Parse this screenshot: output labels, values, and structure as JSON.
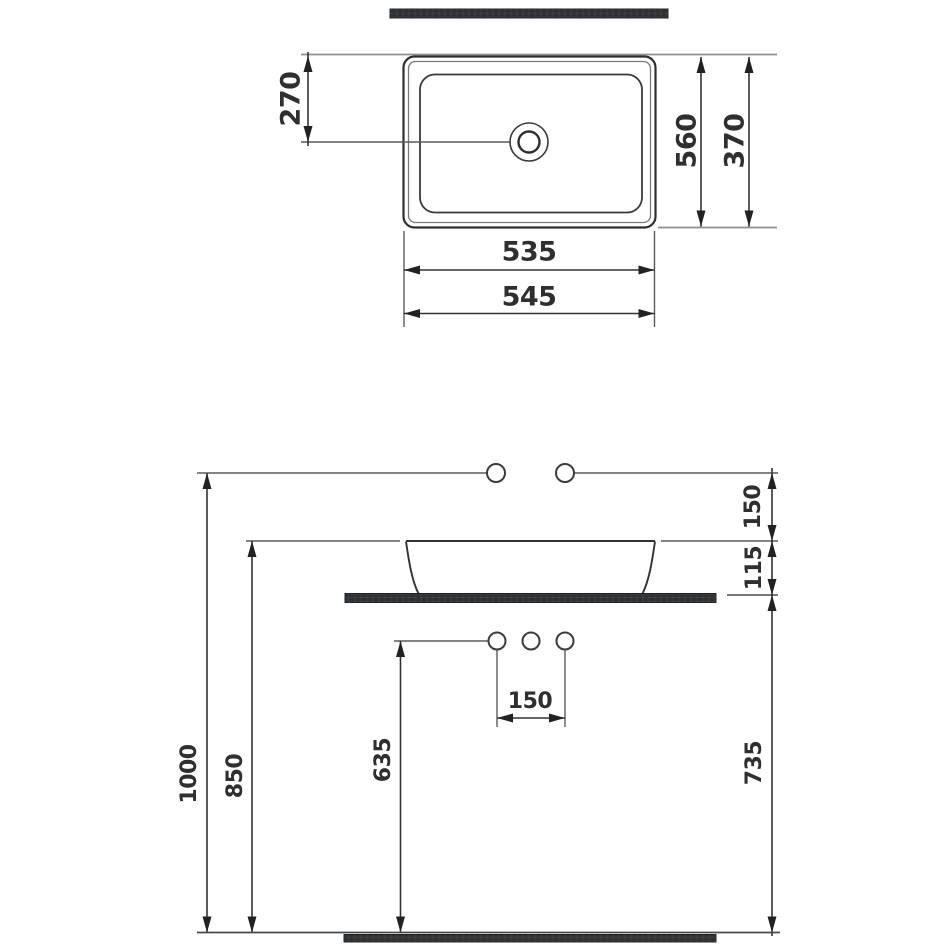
{
  "drawing": {
    "plan_view": {
      "drain_offset": "270",
      "cutout_depth": "560",
      "basin_depth": "370",
      "inner_width": "535",
      "basin_width": "545"
    },
    "front_view": {
      "faucet_drop": "150",
      "basin_height": "115",
      "faucet_line_height": "1000",
      "rim_height": "850",
      "hole_line_height": "635",
      "hole_spacing": "150",
      "counter_drop": "735"
    },
    "colors": {
      "line": "#3a3a3a",
      "reference_line": "#8f8f8f",
      "slab_fill": "#323639",
      "text": "#2f2f2f",
      "background": "#ffffff"
    }
  }
}
